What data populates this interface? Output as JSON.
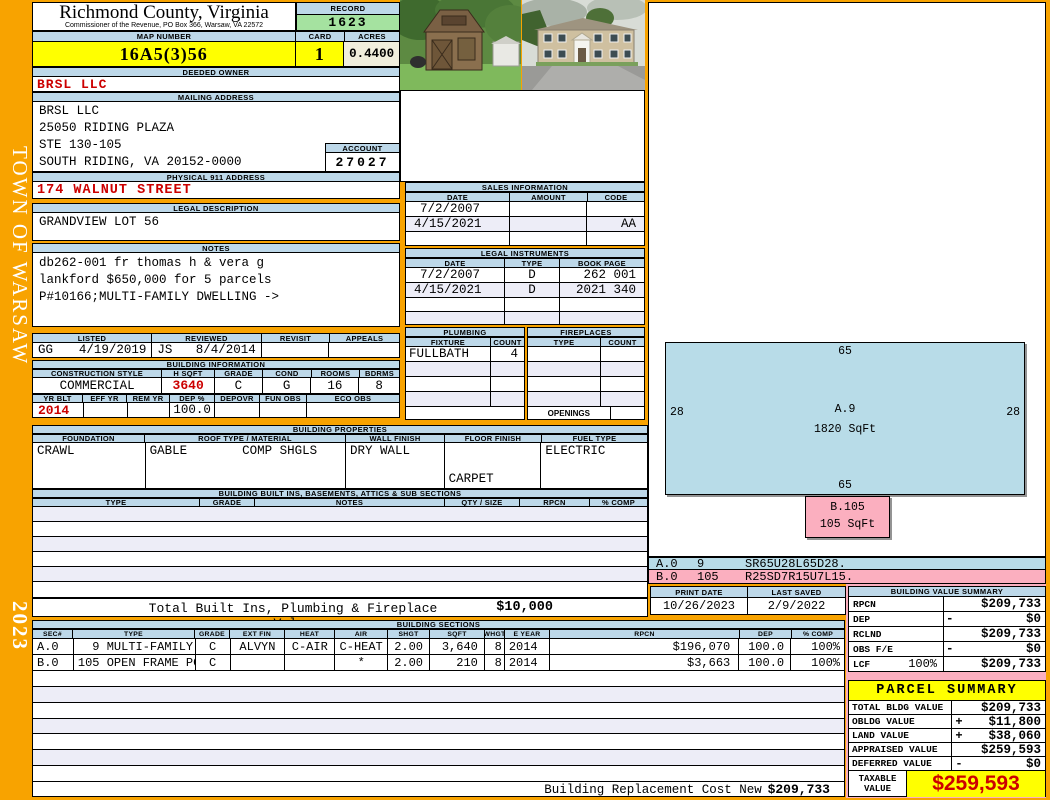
{
  "page": {
    "town": "TOWN OF WARSAW",
    "year": "2023"
  },
  "header": {
    "county": "Richmond County, Virginia",
    "subtitle": "Commissioner of the Revenue, PO Box 366, Warsaw, VA 22572",
    "record_label": "RECORD",
    "record_value": "1623",
    "map_number_label": "MAP NUMBER",
    "map_number": "16A5(3)56",
    "card_label": "CARD",
    "card": "1",
    "acres_label": "ACRES",
    "acres": "0.4400"
  },
  "owner": {
    "deeded_label": "DEEDED OWNER",
    "name": "BRSL LLC",
    "mailing_label": "MAILING ADDRESS",
    "mailing_lines": [
      "BRSL LLC",
      "25050 RIDING PLAZA",
      "STE 130-105",
      "SOUTH RIDING, VA 20152-0000"
    ],
    "account_label": "ACCOUNT",
    "account": "27027",
    "physical_label": "PHYSICAL 911 ADDRESS",
    "physical_address": "174 WALNUT STREET",
    "legal_label": "LEGAL DESCRIPTION",
    "legal_description": "GRANDVIEW LOT 56",
    "notes_label": "NOTES",
    "notes_lines": [
      "db262-001 fr thomas h & vera g",
      "lankford $650,000 for 5 parcels",
      "P#10166;MULTI-FAMILY DWELLING ->"
    ]
  },
  "review": {
    "headers": [
      "LISTED",
      "REVIEWED",
      "REVISIT",
      "APPEALS"
    ],
    "listed_by": "GG",
    "listed_date": "4/19/2019",
    "reviewed_by": "JS",
    "reviewed_date": "8/4/2014"
  },
  "building_info": {
    "label": "BUILDING INFORMATION",
    "row1_headers": [
      "CONSTRUCTION STYLE",
      "H SQFT",
      "GRADE",
      "COND",
      "ROOMS",
      "BDRMS"
    ],
    "row1_values": [
      "COMMERCIAL",
      "3640",
      "C",
      "G",
      "16",
      "8"
    ],
    "row2_headers": [
      "YR BLT",
      "EFF YR",
      "REM YR",
      "DEP %",
      "DEPOVR",
      "FUN OBS",
      "ECO OBS"
    ],
    "row2_values": [
      "2014",
      "",
      "",
      "100.0",
      "",
      "",
      ""
    ]
  },
  "building_properties": {
    "label": "BUILDING PROPERTIES",
    "headers": [
      "FOUNDATION",
      "ROOF TYPE / MATERIAL",
      "WALL FINISH",
      "FLOOR FINISH",
      "FUEL TYPE"
    ],
    "foundation": "CRAWL",
    "roof_type": "GABLE",
    "roof_material": "COMP SHGLS",
    "wall_finish": "DRY WALL",
    "floor_finish_1": "CARPET",
    "floor_finish_2": "VINYL",
    "fuel_type": "ELECTRIC"
  },
  "built_ins": {
    "label": "BUILDING BUILT INS, BASEMENTS, ATTICS & SUB SECTIONS",
    "headers": [
      "TYPE",
      "GRADE",
      "NOTES",
      "QTY / SIZE",
      "RPCN",
      "% COMP"
    ],
    "total_label": "Total Built Ins, Plumbing & Fireplace Value",
    "total_value": "$10,000"
  },
  "sales": {
    "label": "SALES INFORMATION",
    "headers": [
      "DATE",
      "AMOUNT",
      "CODE"
    ],
    "rows": [
      [
        "7/2/2007",
        "",
        ""
      ],
      [
        "4/15/2021",
        "",
        "AA"
      ]
    ]
  },
  "instruments": {
    "label": "LEGAL INSTRUMENTS",
    "headers": [
      "DATE",
      "TYPE",
      "BOOK PAGE"
    ],
    "rows": [
      [
        "7/2/2007",
        "D",
        "262 001"
      ],
      [
        "4/15/2021",
        "D",
        "2021 340"
      ]
    ]
  },
  "plumbing": {
    "label": "PLUMBING",
    "headers": [
      "FIXTURE",
      "COUNT"
    ],
    "fixture": "FULLBATH",
    "count": "4"
  },
  "fireplaces": {
    "label": "FIREPLACES",
    "headers": [
      "TYPE",
      "COUNT"
    ],
    "openings_label": "OPENINGS"
  },
  "sketch": {
    "section_a": {
      "name": "A.9",
      "sqft": "1820 SqFt",
      "dim_top": "65",
      "dim_bottom": "65",
      "dim_left": "28",
      "dim_right": "28"
    },
    "section_b": {
      "name": "B.105",
      "sqft": "105 SqFt"
    },
    "codes": [
      {
        "sec": "A.0",
        "area": "9",
        "code": "SR65U28L65D28."
      },
      {
        "sec": "B.0",
        "area": "105",
        "code": "R25SD7R15U7L15."
      }
    ]
  },
  "print_info": {
    "print_date_label": "PRINT DATE",
    "print_date": "10/26/2023",
    "last_saved_label": "LAST SAVED",
    "last_saved": "2/9/2022"
  },
  "building_value_summary": {
    "label": "BUILDING VALUE SUMMARY",
    "rows": [
      {
        "label": "RPCN",
        "extra": "",
        "sign": "",
        "value": "$209,733"
      },
      {
        "label": "DEP",
        "extra": "",
        "sign": "-",
        "value": "$0"
      },
      {
        "label": "RCLND",
        "extra": "",
        "sign": "",
        "value": "$209,733"
      },
      {
        "label": "OBS F/E",
        "extra": "",
        "sign": "-",
        "value": "$0"
      },
      {
        "label": "LCF",
        "extra": "100%",
        "sign": "",
        "value": "$209,733"
      }
    ]
  },
  "parcel_summary": {
    "label": "PARCEL SUMMARY",
    "rows": [
      {
        "label": "TOTAL BLDG VALUE",
        "sign": "",
        "value": "$209,733"
      },
      {
        "label": "OBLDG VALUE",
        "sign": "+",
        "value": "$11,800"
      },
      {
        "label": "LAND VALUE",
        "sign": "+",
        "value": "$38,060"
      },
      {
        "label": "APPRAISED VALUE",
        "sign": "",
        "value": "$259,593"
      },
      {
        "label": "DEFERRED VALUE",
        "sign": "-",
        "value": "$0"
      }
    ],
    "taxable_label_1": "TAXABLE",
    "taxable_label_2": "VALUE",
    "taxable_value": "$259,593"
  },
  "building_sections": {
    "label": "BUILDING SECTIONS",
    "headers": [
      "SEC#",
      "TYPE",
      "GRADE",
      "EXT FIN",
      "HEAT",
      "AIR",
      "SHGT",
      "SQFT",
      "WHGT",
      "E YEAR",
      "RPCN",
      "DEP",
      "% COMP"
    ],
    "rows": [
      [
        "A.0",
        "  9 MULTI-FAMILY",
        "C",
        "ALVYN",
        "C-AIR",
        "C-HEAT",
        "2.00",
        "3,640",
        "8",
        "2014",
        "$196,070",
        "100.0",
        "100%"
      ],
      [
        "B.0",
        "105 OPEN FRAME PCH",
        "C",
        "",
        "",
        "*",
        "2.00",
        "210",
        "8",
        "2014",
        "$3,663",
        "100.0",
        "100%"
      ]
    ],
    "replacement_label": "Building Replacement Cost New",
    "replacement_value": "$209,733"
  },
  "colors": {
    "accent_orange": "#F8A300",
    "header_blue": "#BDD8E9",
    "record_green": "#A5E2A0",
    "highlight_yellow": "#FFFF00",
    "value_red": "#CC0000",
    "sketch_blue": "#B8DCE8",
    "sketch_pink": "#FBAFBF"
  }
}
